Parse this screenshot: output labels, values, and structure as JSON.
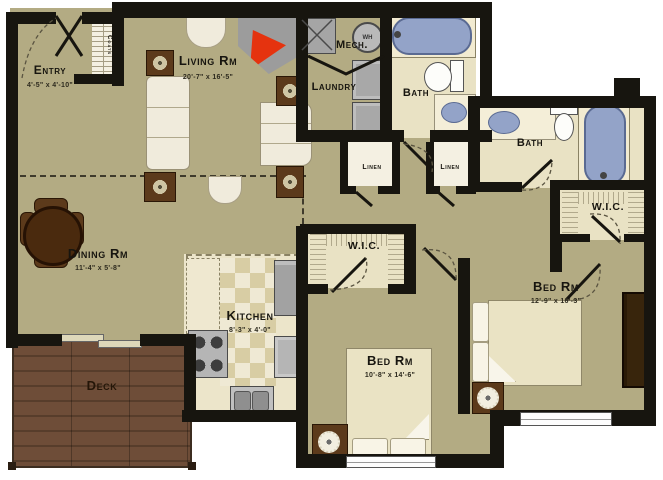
{
  "rooms": {
    "entry": {
      "label": "Entry",
      "dims": "4'-5\" x 4'-10\""
    },
    "living": {
      "label": "Living Rm",
      "dims": "20'-7\" x 16'-5\""
    },
    "dining": {
      "label": "Dining Rm",
      "dims": "11'-4\" x 5'-8\""
    },
    "kitchen": {
      "label": "Kitchen",
      "dims": "8'-3\" x 4'-0\""
    },
    "mech": {
      "label": "Mech."
    },
    "laundry": {
      "label": "Laundry"
    },
    "bath_top": {
      "label": "Bath"
    },
    "bath_right": {
      "label": "Bath"
    },
    "linen_left": {
      "label": "Linen"
    },
    "linen_right": {
      "label": "Linen"
    },
    "wic_middle": {
      "label": "W.I.C."
    },
    "wic_right": {
      "label": "W.I.C."
    },
    "bed_middle": {
      "label": "Bed Rm",
      "dims": "10'-8\" x 14'-6\""
    },
    "bed_right": {
      "label": "Bed Rm",
      "dims": "12'-9\" x 16'-3\""
    },
    "deck": {
      "label": "Deck"
    },
    "coats": {
      "label": "Coats"
    }
  },
  "fixtures": {
    "water_heater_label": "WH"
  },
  "colors": {
    "wall": "#17150f",
    "main_floor": "#b3ab83",
    "light_floor": "#e9e2c4",
    "fixture_blue": "#93a3c8",
    "deck_wood": "#6e4d38",
    "fireplace_red": "#e5330f"
  }
}
